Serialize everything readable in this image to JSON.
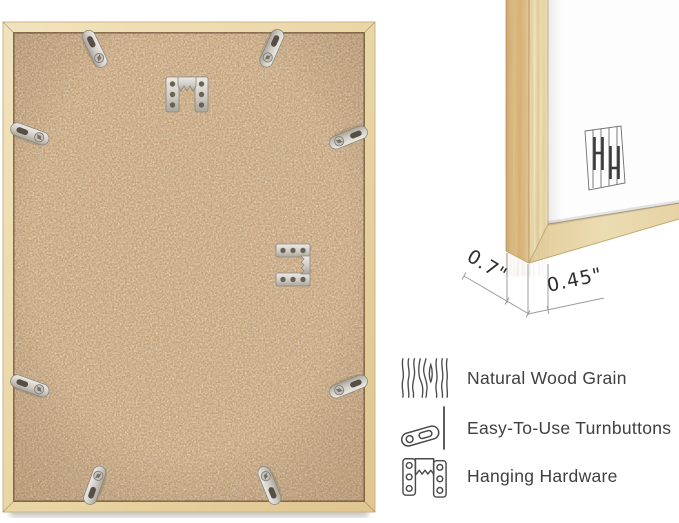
{
  "page": {
    "background": "#ffffff"
  },
  "colors": {
    "wood_light": "#efe0b8",
    "wood_medium": "#e2c792",
    "wood_side": "#d9b67e",
    "mdf_board": "#c7a47c",
    "metal": "#cfccc5",
    "dimension_line": "#9c9c9c",
    "dimension_text": "#2e2e2e",
    "label_text": "#3f3f3f"
  },
  "frame_back_view": {
    "hardware_visible": {
      "turnbutton_count": 8,
      "sawtooth_hanger_count": 2
    }
  },
  "corner_closeup": {
    "dimensions": {
      "frame_depth_label": "0.7\"",
      "frame_face_label": "0.45\""
    }
  },
  "features": [
    {
      "icon": "wood-grain-icon",
      "label": "Natural Wood Grain"
    },
    {
      "icon": "turnbutton-icon",
      "label": "Easy-To-Use Turnbuttons"
    },
    {
      "icon": "hanging-hardware-icon",
      "label": "Hanging Hardware"
    }
  ]
}
